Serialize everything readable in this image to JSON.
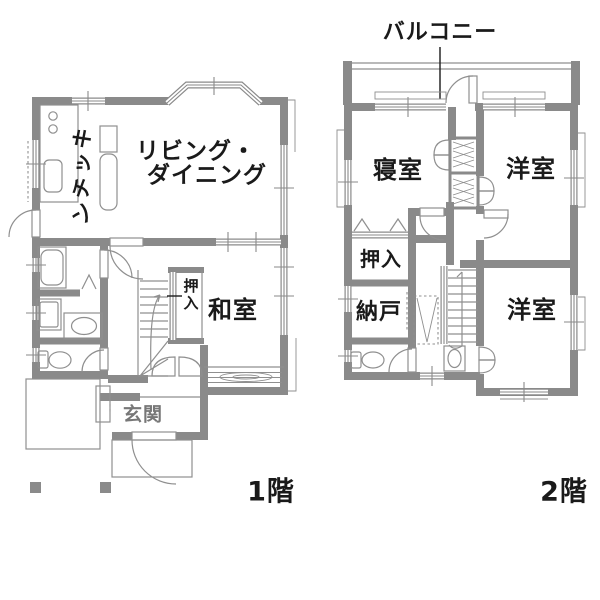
{
  "colors": {
    "wall": "#8a8a8a",
    "fixture": "#8f8f8f",
    "text": "#1a1a1a",
    "entrance_text": "#777777",
    "bg": "#ffffff"
  },
  "floor1": {
    "label": "1階",
    "rooms": {
      "kitchen": "キッチン",
      "living_line1": "リビング・",
      "living_line2": "ダイニング",
      "closet": "押入",
      "japanese_room": "和室",
      "entrance": "玄関"
    }
  },
  "floor2": {
    "label": "2階",
    "balcony": "バルコニー",
    "rooms": {
      "bedroom": "寝室",
      "western_room_top": "洋室",
      "closet": "押入",
      "storage": "納戸",
      "western_room_bottom": "洋室"
    }
  }
}
